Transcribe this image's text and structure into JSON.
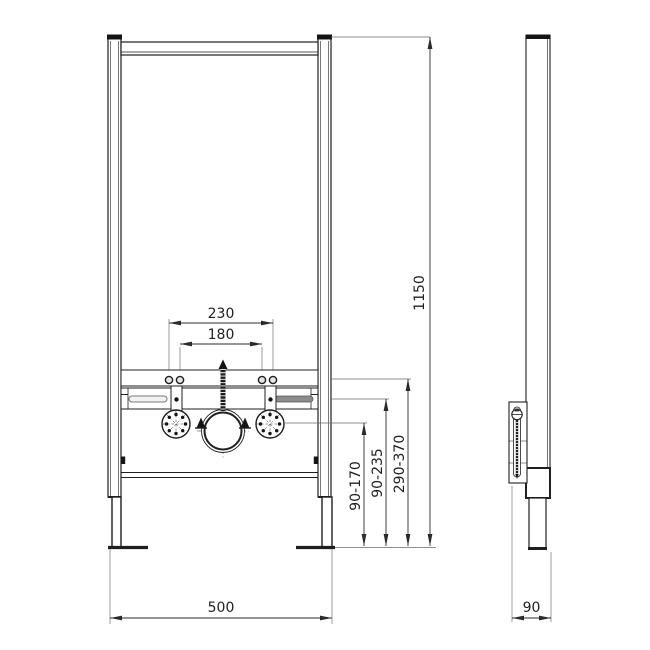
{
  "dims": {
    "bolt_spacing_outer": "230",
    "bolt_spacing_inner": "180",
    "frame_height": "1150",
    "height_range_small": "90-170",
    "height_range_mid": "90-235",
    "height_range_large": "290-370",
    "frame_width": "500",
    "frame_depth": "90"
  }
}
